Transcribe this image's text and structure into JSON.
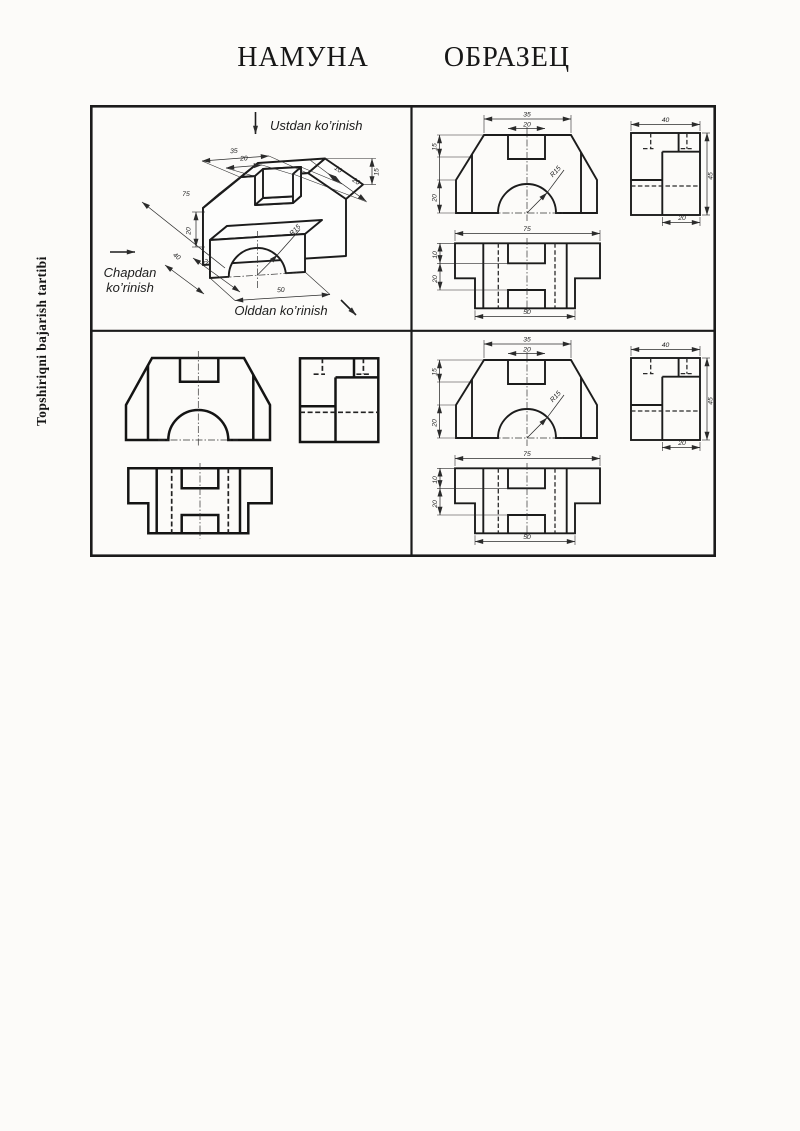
{
  "page": {
    "title_left": "НАМУНА",
    "title_right": "ОБРАЗЕЦ",
    "sidebar_text": "Topshiriqni bajarish tartibi"
  },
  "iso": {
    "view_labels": {
      "top": "Ustdan ko’rinish",
      "left_line1": "Chapdan",
      "left_line2": "ko’rinish",
      "front": "Olddan ko’rinish"
    },
    "dims": {
      "top_width": "35",
      "slot_width": "20",
      "base_width": "75",
      "left_height": "20",
      "depth_total": "40",
      "depth_front": "20",
      "slot_depth": "10",
      "slot_back_depth": "20",
      "bevel_height": "15",
      "radius": "R15",
      "front_width": "50"
    }
  },
  "ortho": {
    "front": {
      "top_width": "35",
      "slot_width": "20",
      "bevel_height": "15",
      "left_height": "20",
      "radius": "R15"
    },
    "side": {
      "width": "40",
      "height": "45",
      "depth_front": "20"
    },
    "top": {
      "width": "75",
      "slot_depth": "10",
      "mid_depth": "20",
      "front_width": "50"
    }
  }
}
